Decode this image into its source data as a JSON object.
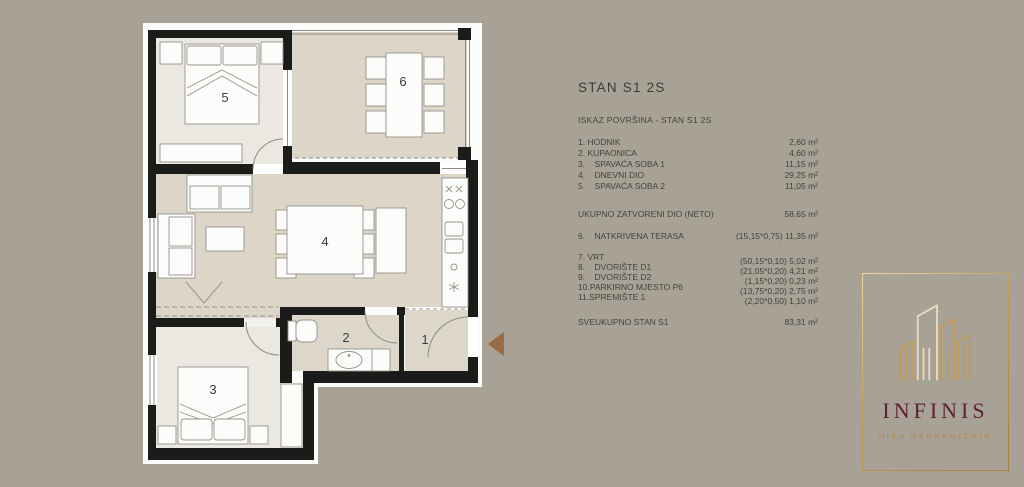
{
  "colors": {
    "background": "#a8a196",
    "wall": "#1b1b19",
    "floor_light": "#ebe8e1",
    "floor_beige": "#dcd5c8",
    "gold": "#c49a52",
    "maroon": "#5c2134",
    "arrow_brown": "#9b6b45"
  },
  "floor_plan": {
    "room_numbers": {
      "r5": "5",
      "r6": "6",
      "r4": "4",
      "r2": "2",
      "r1": "1",
      "r3": "3"
    }
  },
  "panel": {
    "title": "STAN S1 2S",
    "subtitle": "ISKAZ POVRŠINA - STAN S1 2S",
    "rooms": [
      {
        "label": "1. HODNIK",
        "value": "2,60 m²"
      },
      {
        "label": "2. KUPAONICA",
        "value": "4,60 m²"
      },
      {
        "label": "3.    SPAVAĆA SOBA 1",
        "value": "11,15 m²"
      },
      {
        "label": "4.    DNEVNI DIO",
        "value": "29,25 m²"
      },
      {
        "label": "5.    SPAVAĆA SOBA 2",
        "value": "11,05 m²"
      }
    ],
    "neto_label": "UKUPNO ZATVORENI DIO (NETO)",
    "neto_value": "58,65 m²",
    "terrace_label": "6.    NATKRIVENA TERASA",
    "terrace_value": "(15,15*0,75) 11,35 m²",
    "outdoor": [
      {
        "label": "7. VRT",
        "value": "(50,15*0,10) 5,02 m²"
      },
      {
        "label": "8.    DVORIŠTE D1",
        "value": "(21,05*0,20) 4,21 m²"
      },
      {
        "label": "9.    DVORIŠTE D2",
        "value": "(1,15*0,20) 0,23 m²"
      },
      {
        "label": "10.PARKIRNO MJESTO P6",
        "value": "(13,75*0,20) 2,75 m²"
      },
      {
        "label": "11.SPREMIŠTE 1",
        "value": "(2,20*0,50) 1,10 m²"
      }
    ],
    "total_label": "SVEUKUPNO STAN S1",
    "total_value": "83,31 m²"
  },
  "logo": {
    "name": "INFINIS",
    "tagline": "HIŠA NEPREMIČNIN"
  }
}
